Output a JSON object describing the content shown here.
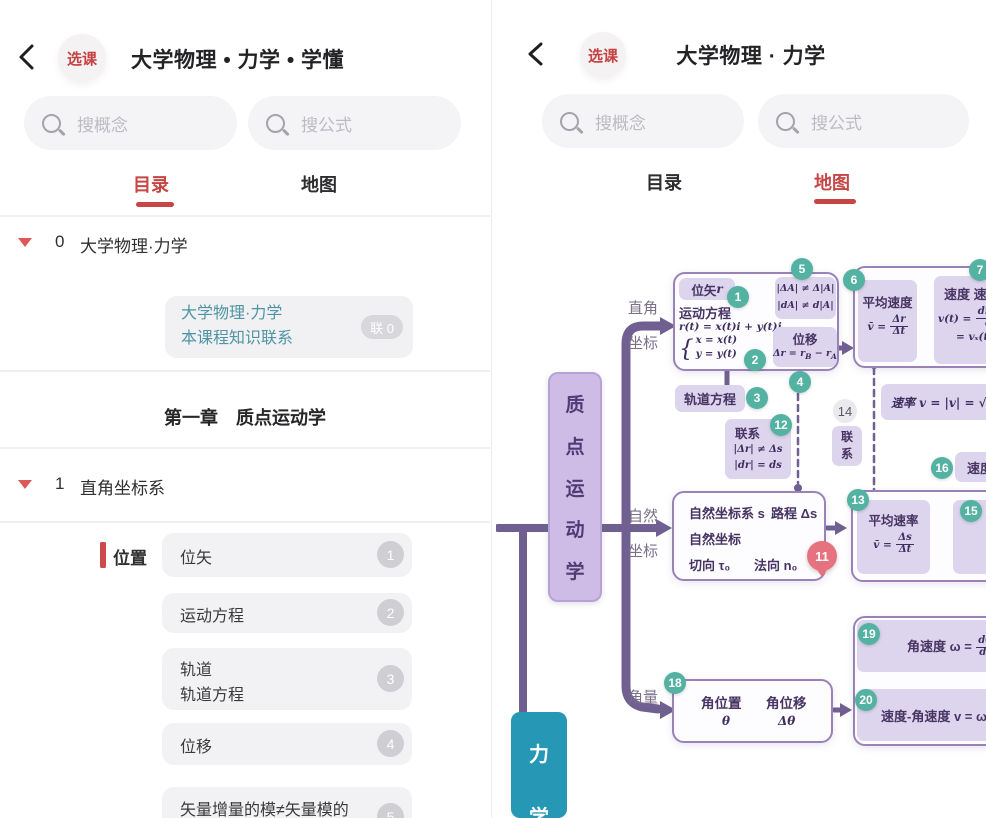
{
  "colors": {
    "accent_red": "#c64545",
    "teal_badge": "#54b2a2",
    "purple_line": "#706092",
    "node_purple": "#ddd4ee",
    "pin_pink": "#e7727f",
    "next_chapter_blue": "#2697b5",
    "link_teal_text": "#4e95a3"
  },
  "left": {
    "header": {
      "badge": "选课",
      "title": "大学物理 • 力学 • 学懂"
    },
    "search": {
      "concept": "搜概念",
      "formula": "搜公式"
    },
    "tabs": {
      "catalog": "目录",
      "map": "地图"
    },
    "tree0": {
      "num": "0",
      "label": "大学物理·力学"
    },
    "link_card": {
      "line1": "大学物理·力学",
      "line2": "本课程知识联系",
      "badge": "联 0"
    },
    "chapter": "第一章　质点运动学",
    "tree1": {
      "num": "1",
      "label": "直角坐标系"
    },
    "group_label": "位置",
    "items": [
      {
        "text": "位矢",
        "badge": "1"
      },
      {
        "text": "运动方程",
        "badge": "2"
      },
      {
        "text": "轨道",
        "text2": "轨道方程",
        "badge": "3"
      },
      {
        "text": "位移",
        "badge": "4"
      },
      {
        "text": "矢量增量的模≠矢量模的",
        "badge": "5"
      }
    ]
  },
  "right": {
    "header": {
      "badge": "选课",
      "title": "大学物理 · 力学"
    },
    "search": {
      "concept": "搜概念",
      "formula": "搜公式"
    },
    "tabs": {
      "catalog": "目录",
      "map": "地图"
    },
    "map": {
      "root_chars": {
        "c0": "质",
        "c1": "点",
        "c2": "运",
        "c3": "动",
        "c4": "学"
      },
      "branch_rect_1": "直角",
      "branch_rect_2": "坐标",
      "branch_nat_1": "自然",
      "branch_nat_2": "坐标",
      "branch_ang": "角量",
      "n1": {
        "badge": "1",
        "t": "位矢 ",
        "v": "r"
      },
      "n2": {
        "badge": "2",
        "title": "运动方程",
        "f1": "r(t) = x(t)i + y(t)j",
        "brace": "{",
        "c1": "x = x(t)",
        "c2": "y = y(t)"
      },
      "n5": {
        "badge": "5",
        "l1": "|ΔA| ≠ Δ|A|",
        "l2": "|dA| ≠ d|A|"
      },
      "n4": {
        "badge": "4",
        "title": "位移",
        "f_pre": "Δr = r",
        "f_sub1": "B",
        "f_mid": " − r",
        "f_sub2": "A"
      },
      "n3": {
        "badge": "3",
        "title": "轨道方程"
      },
      "n12": {
        "badge": "12",
        "title": "联系",
        "l1": "|Δr| ≠ Δs",
        "l2": "|dr| = ds"
      },
      "n14": {
        "badge": "14",
        "c1": "联",
        "c2": "系"
      },
      "n6": {
        "badge": "6",
        "title": "平均速度",
        "lhs": "v̄ =",
        "num": "Δr",
        "den": "Δt"
      },
      "n7": {
        "badge": "7",
        "title": "速度 速",
        "lhs": "v(t) =",
        "num": "dr(t)",
        "den": "dt",
        "l2": "= vₓ(t"
      },
      "nrate": {
        "text": "速率 v = |v| = √"
      },
      "n16": {
        "badge": "16",
        "title": "速度"
      },
      "n11": {
        "pin": "11",
        "l1a": "自然坐标系 s",
        "l1b": "路程 Δs",
        "l2": "自然坐标",
        "l3a": "切向 τ₀",
        "l3b": "法向 n₀"
      },
      "n13": {
        "badge": "13",
        "title": "平均速率",
        "lhs": "v̄ =",
        "num": "Δs",
        "den": "Δt"
      },
      "n15": {
        "badge": "15"
      },
      "n18": {
        "badge": "18",
        "c1": "角位置",
        "c1v": "θ",
        "c2": "角位移",
        "c2v": "Δθ"
      },
      "n19": {
        "badge": "19",
        "pre": "角速度 ω =",
        "num": "dθ",
        "den": "dt"
      },
      "n20": {
        "badge": "20",
        "text": "速度-角速度 v = ω"
      },
      "next_node": {
        "c1": "力",
        "c2": "学"
      }
    }
  }
}
